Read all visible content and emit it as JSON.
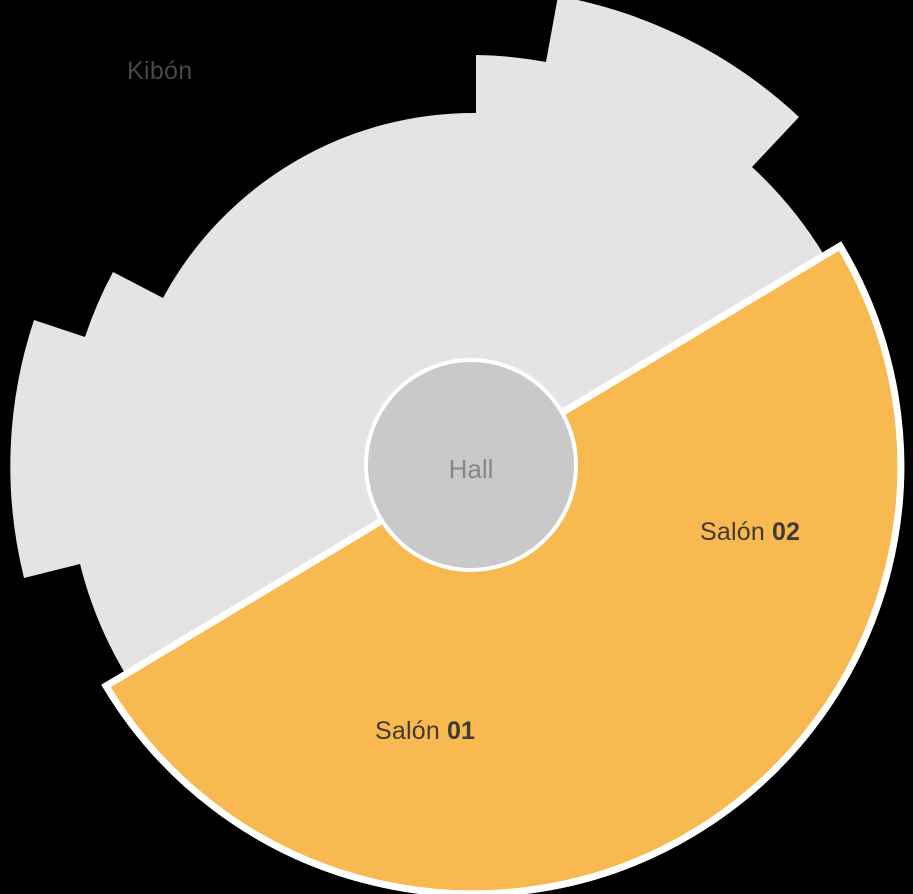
{
  "background": "#000000",
  "colors": {
    "unavailable_fill": "#e4e4e4",
    "selected_fill": "#f7b950",
    "selected_outline": "#ffffff",
    "hall_fill": "#c9c9c9",
    "hall_outline": "#ffffff",
    "hall_text": "#878787",
    "venue_title_text": "#45484c",
    "section_text": "#3f3b33"
  },
  "venue": {
    "name": "Kibón"
  },
  "hall": {
    "label": "Hall"
  },
  "sections": [
    {
      "name": "Salón",
      "number": "01"
    },
    {
      "name": "Salón",
      "number": "02"
    }
  ]
}
